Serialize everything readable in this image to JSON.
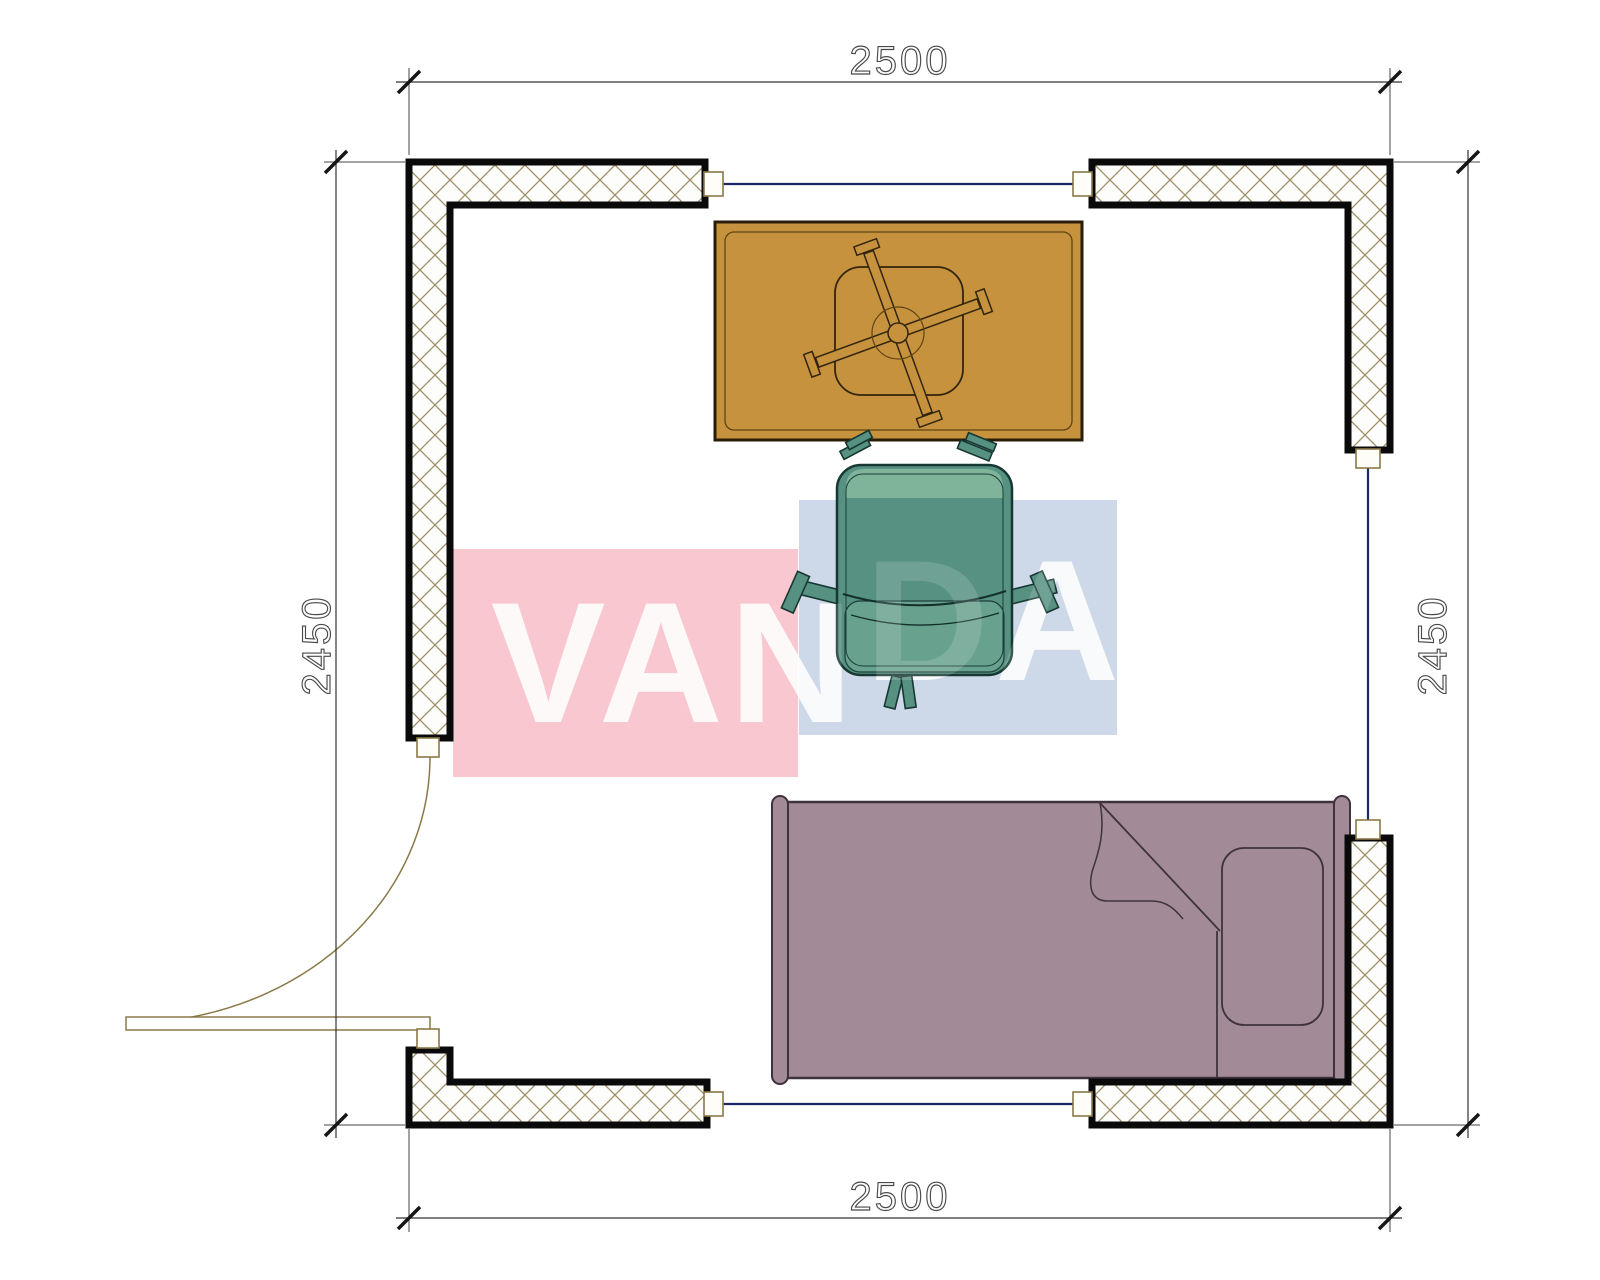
{
  "drawing": {
    "dimensions": {
      "top": "2500",
      "bottom": "2500",
      "left": "2450",
      "right": "2450"
    },
    "watermark": {
      "text": "VANDA",
      "part1": "VAN",
      "part2": "DA",
      "pink": "#f8c7cf",
      "blue": "#cdd8e8",
      "letter_color": "#ffffff"
    },
    "palette": {
      "desk": "#c6923e",
      "desk_outline": "#2a1d07",
      "chair": "#579182",
      "chair_top": "#7fb39a",
      "chair_seat": "#68a18d",
      "chair_outline": "#173832",
      "bed": "#a28a96",
      "bed_outline": "#3e333d",
      "wall_hatch": "#9e8e66",
      "window_line": "#1d2766",
      "door_line": "#8a7948",
      "dim_color": "#4a4a4a"
    }
  }
}
